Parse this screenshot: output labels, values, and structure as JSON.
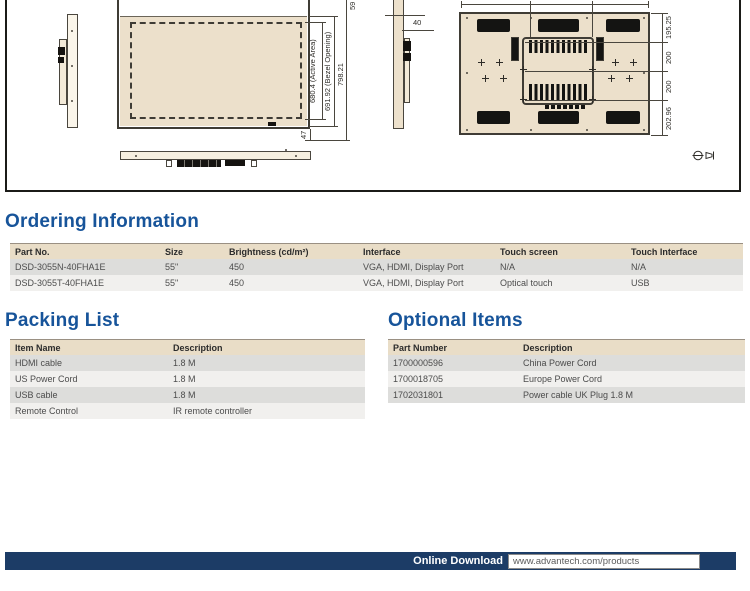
{
  "drawing": {
    "labels": {
      "partial_top": "59",
      "active_area": "680.4 (Active Area)",
      "bezel_opening": "691.92 (Bezel Opening)",
      "overall": "798.21",
      "bottom": "47",
      "depth": "40",
      "back_top": "195.25",
      "back_mid1": "200",
      "back_mid2": "200",
      "back_bottom": "202.96"
    }
  },
  "ordering": {
    "title": "Ordering Information",
    "headers": [
      "Part No.",
      "Size",
      "Brightness (cd/m²)",
      "Interface",
      "Touch screen",
      "Touch Interface"
    ],
    "rows": [
      [
        "DSD-3055N-40FHA1E",
        "55\"",
        "450",
        "VGA, HDMI, Display Port",
        "N/A",
        "N/A"
      ],
      [
        "DSD-3055T-40FHA1E",
        "55\"",
        "450",
        "VGA, HDMI, Display Port",
        "Optical touch",
        "USB"
      ]
    ]
  },
  "packing": {
    "title": "Packing List",
    "headers": [
      "Item Name",
      "Description"
    ],
    "rows": [
      [
        "HDMI cable",
        "1.8 M"
      ],
      [
        "US Power Cord",
        "1.8 M"
      ],
      [
        "USB cable",
        "1.8 M"
      ],
      [
        "Remote Control",
        "IR remote controller"
      ]
    ]
  },
  "optional": {
    "title": "Optional Items",
    "headers": [
      "Part Number",
      "Description"
    ],
    "rows": [
      [
        "1700000596",
        "China Power Cord"
      ],
      [
        "1700018705",
        "Europe Power Cord"
      ],
      [
        "1702031801",
        "Power cable UK Plug 1.8 M"
      ]
    ]
  },
  "footer": {
    "label": "Online Download",
    "url": "www.advantech.com/products"
  },
  "colors": {
    "heading_blue": "#17549a",
    "footer_navy": "#1c3c66",
    "table_header_tan": "#e9ddc7",
    "drawing_tan": "#ece0cb"
  }
}
